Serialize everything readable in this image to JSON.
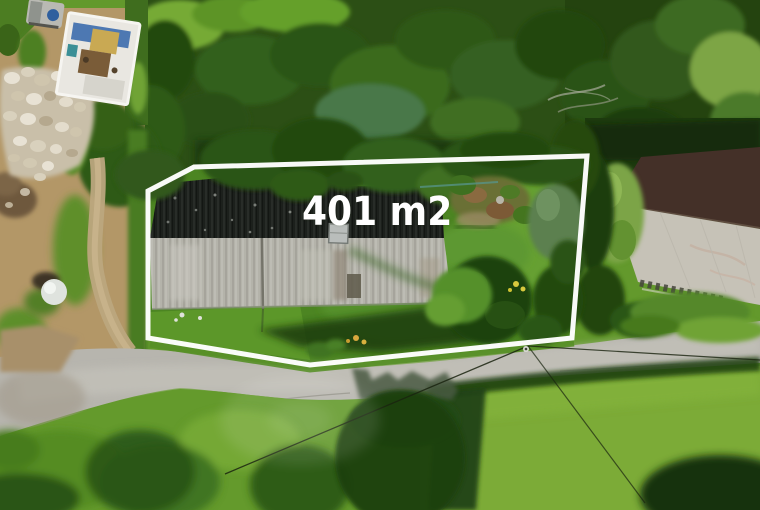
{
  "overlay": {
    "area_label": "401 m2",
    "boundary_color": "#ffffff",
    "label_color": "#ffffff"
  },
  "scene": {
    "type": "aerial-drone-photo",
    "features": [
      "property-boundary-outline",
      "barn-black-roof",
      "barn-gray-corrugated-roof",
      "roof-skylight",
      "neighbor-house-roof",
      "access-road",
      "forest-canopy",
      "garden-beds",
      "dirt-yard",
      "rock-pile",
      "covered-work-table",
      "trailer-with-blue-barrel",
      "white-dome-tank",
      "gravel-path",
      "utility-wires",
      "meadow",
      "tree-shadows"
    ]
  },
  "palette": {
    "canopy_dark": "#22470f",
    "canopy_light": "#65a02c",
    "meadow_bright": "#7cab37",
    "road_gray": "#b7b5ae",
    "dirt_tan": "#b39767",
    "barn_black_roof": "#1c201c",
    "barn_gray_roof": "#b4b3aa",
    "house_roof_light": "#c6c2b7",
    "house_roof_dark": "#443028"
  }
}
